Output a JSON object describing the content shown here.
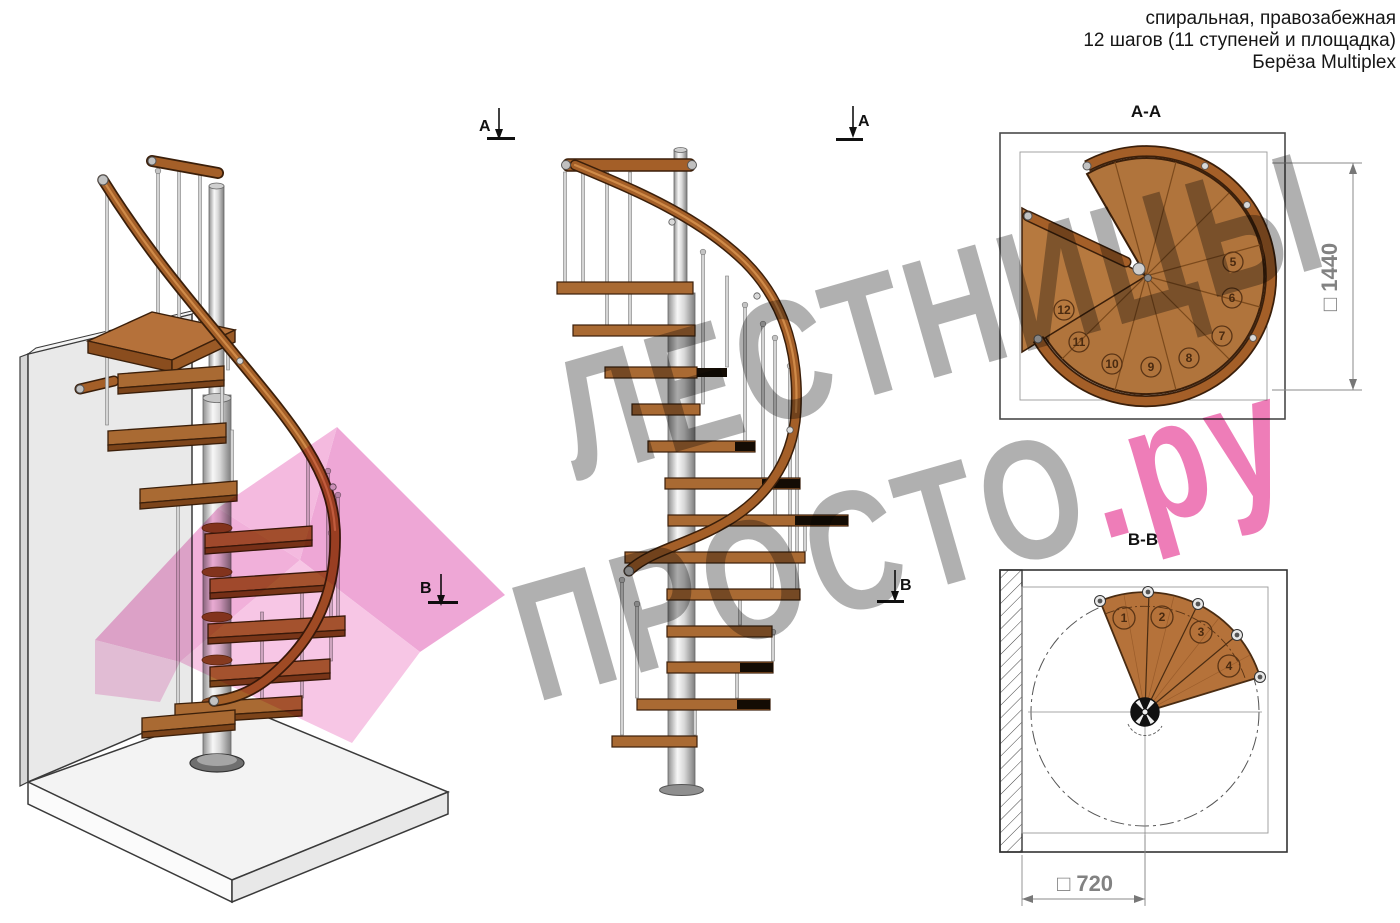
{
  "header": {
    "line1": "спиральная, правозабежная",
    "line2": "12 шагов (11 ступеней и площадка)",
    "line3": "Берёза Multiplex"
  },
  "watermark": {
    "line1": "ЛЕСТНИЦЫ",
    "line2_gray": "ПРОСТО",
    "line2_pink": ".ру"
  },
  "sections": {
    "a_label": "А",
    "b_label": "В",
    "aa_title": "А-А",
    "bb_title": "В-В"
  },
  "dimensions": {
    "aa_label": "□ 1440",
    "bb_label": "□ 720"
  },
  "plans": {
    "aa_steps": [
      "5",
      "6",
      "7",
      "8",
      "9",
      "10",
      "11",
      "12"
    ],
    "bb_steps": [
      "1",
      "2",
      "3",
      "4"
    ]
  },
  "colors": {
    "wood": "#a96a33",
    "wood_dark": "#3b1f0a",
    "handrail": "#a45f28",
    "pink_overlay": "#f2aed9",
    "metal": "#d5d5d5",
    "watermark_gray": "#8a8a8a",
    "watermark_pink": "#e0127e",
    "dimension_gray": "#828282"
  }
}
